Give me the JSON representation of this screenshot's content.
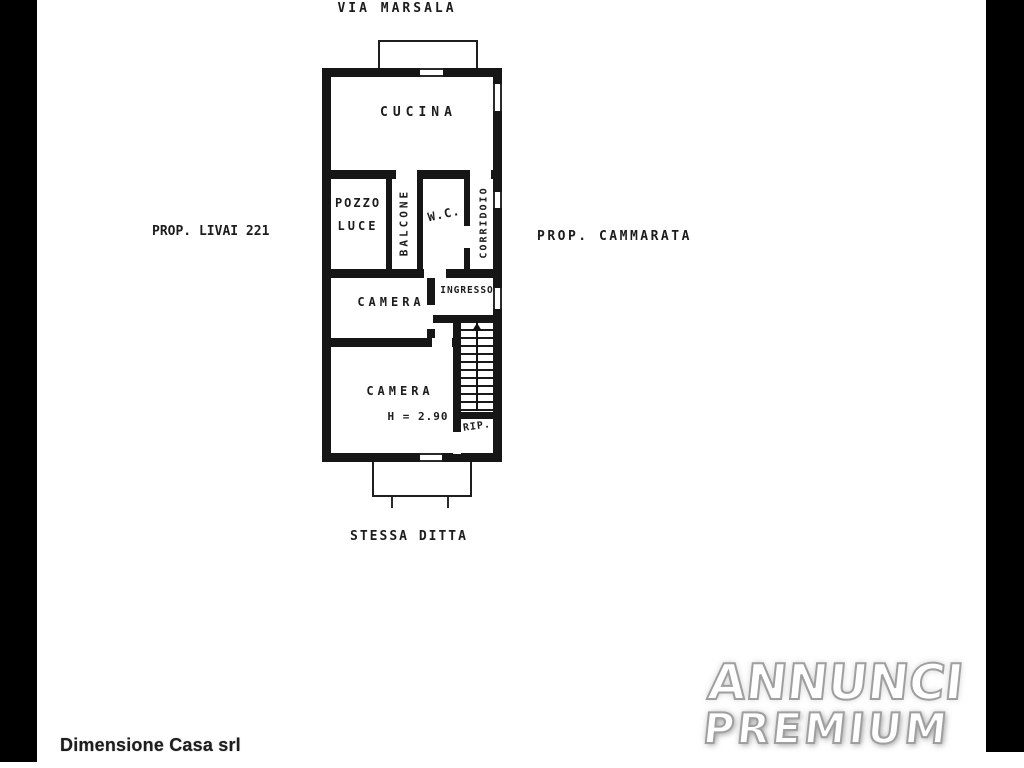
{
  "scan": {
    "street": "VIA MARSALA",
    "neighbor_left": "PROP. LIVAI 221",
    "neighbor_right": "PROP. CAMMARATA",
    "neighbor_bottom": "STESSA DITTA",
    "rooms": {
      "cucina": "CUCINA",
      "pozzo_line1": "POZZO",
      "pozzo_line2": "LUCE",
      "balcone": "BALCONE",
      "wc": "W.C.",
      "corridoio": "CORRIDOIO",
      "camera_1": "CAMERA",
      "ingresso": "INGRESSO",
      "camera_2": "CAMERA",
      "height_note": "H = 2.90",
      "ripostiglio": "RIP."
    }
  },
  "footer": {
    "agency_name": "Dimensione Casa srl"
  },
  "watermark": {
    "line1": "ANNUNCI",
    "line2": "PREMIUM"
  },
  "colors": {
    "ink": "#161616",
    "paper": "#ffffff",
    "bar": "#000000",
    "watermark_outline": "#9f9f9f"
  }
}
